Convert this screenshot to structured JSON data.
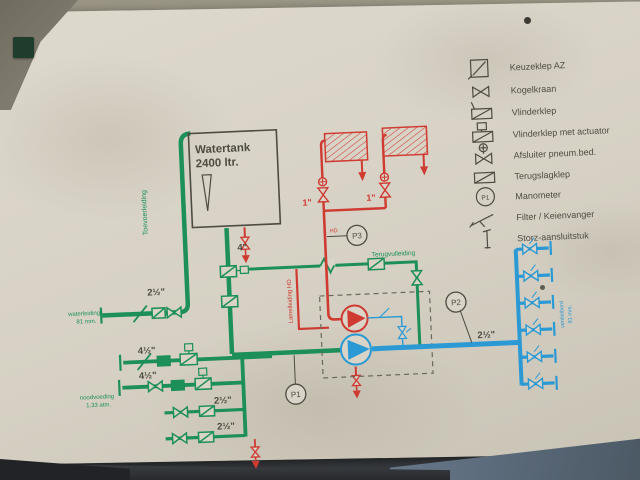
{
  "diagram": {
    "tank": {
      "line1": "Watertank",
      "line2": "2400 ltr."
    },
    "pipe_labels": {
      "inlet": "2½\"",
      "tank_outlet": "4\"",
      "spray_left": "1\"",
      "spray_right": "1\"",
      "suction1": "4½\"",
      "suction2": "4½\"",
      "suction3": "2½\"",
      "suction4": "2½\"",
      "distribution": "2½\""
    },
    "line_names": {
      "supply": "Toevoerleiding",
      "return": "Terugvulleiding",
      "lamel": "Lamelleiding HD",
      "hd": "HD"
    },
    "notes": {
      "inlet_l1": "waterleiding",
      "inlet_l2": "81 mm.",
      "emergency_l1": "noodvoeding",
      "emergency_l2": "1.33 atm.",
      "manifold_l1": "ventielbord",
      "manifold_l2": "81 mm."
    },
    "gauges": {
      "p1": "P1",
      "p2": "P2",
      "p3": "P3"
    }
  },
  "legend": {
    "manometer_symbol_text": "P1",
    "items": [
      {
        "label": "Keuzeklep AZ",
        "icon": "keuzeklep-icon"
      },
      {
        "label": "Kogelkraan",
        "icon": "kogelkraan-icon"
      },
      {
        "label": "Vlinderklep",
        "icon": "vlinderklep-icon"
      },
      {
        "label": "Vlinderklep met actuator",
        "icon": "vlinderklep-actuator-icon"
      },
      {
        "label": "Afsluiter pneum.bed.",
        "icon": "afsluiter-pneum-icon"
      },
      {
        "label": "Terugslagklep",
        "icon": "terugslagklep-icon"
      },
      {
        "label": "Manometer",
        "icon": "manometer-icon"
      },
      {
        "label": "Filter / Keienvanger",
        "icon": "filter-icon"
      },
      {
        "label": "Storz-aansluitstuk",
        "icon": "storz-icon"
      }
    ]
  },
  "colors": {
    "green": "#1d8f58",
    "red": "#cf3a31",
    "blue": "#2b99d4",
    "ink": "#4e4b42",
    "board": "#d9d4c7"
  }
}
